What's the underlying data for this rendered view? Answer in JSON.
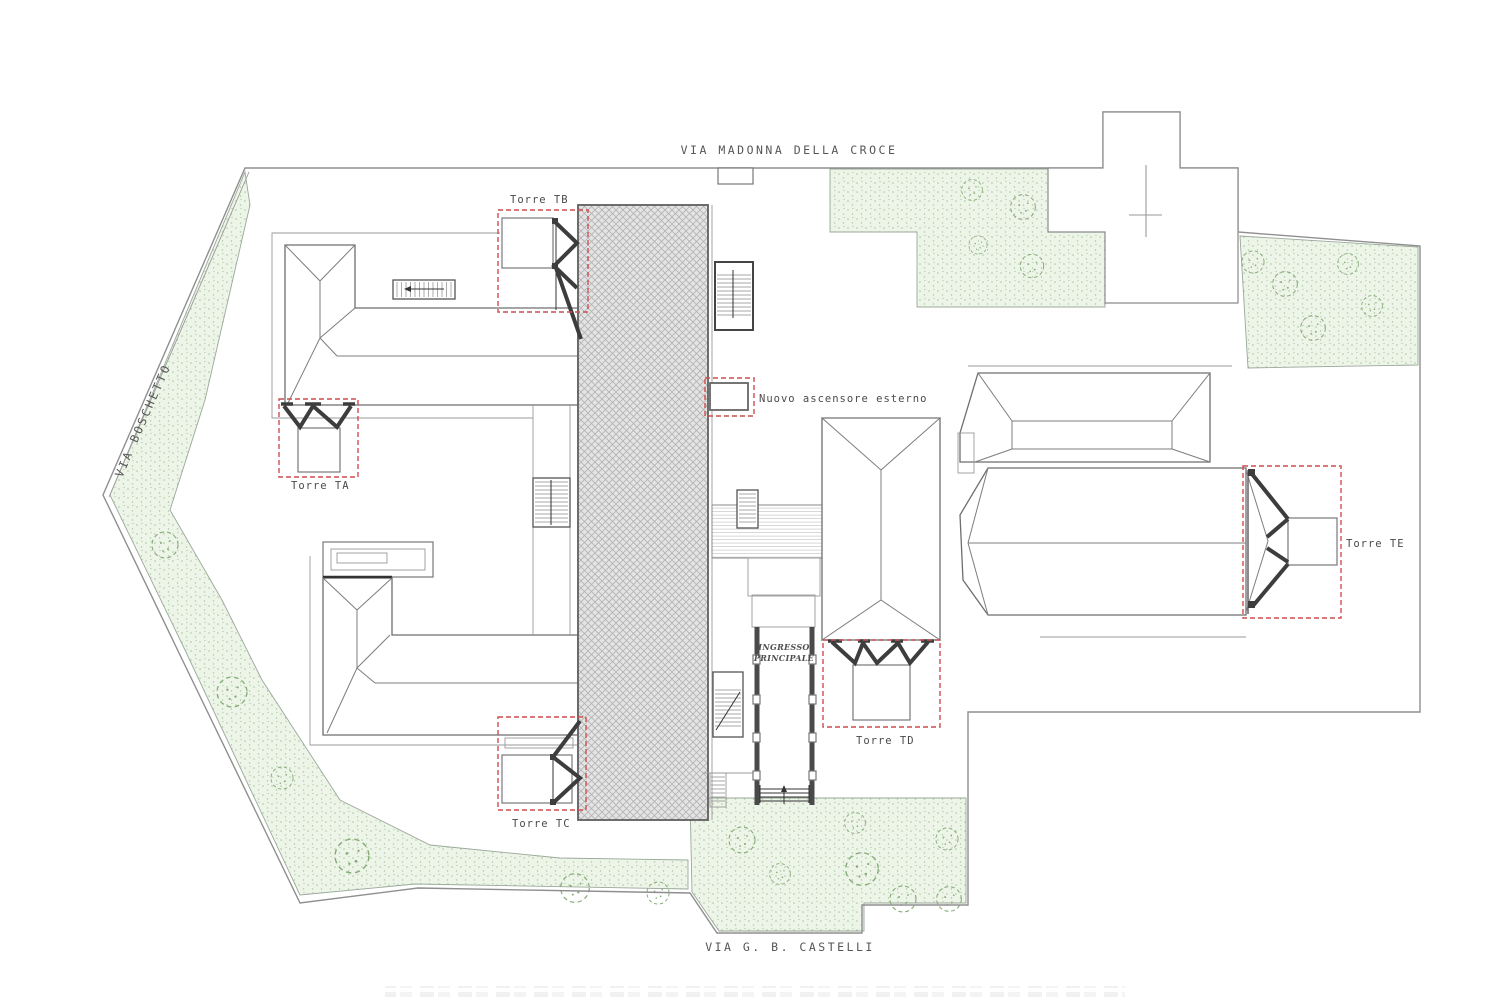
{
  "streets": {
    "top": "VIA MADONNA DELLA CROCE",
    "left": "VIA BOSCHETTO",
    "bottom": "VIA G. B. CASTELLI"
  },
  "towers": [
    {
      "id": "TA",
      "label": "Torre TA"
    },
    {
      "id": "TB",
      "label": "Torre TB"
    },
    {
      "id": "TC",
      "label": "Torre TC"
    },
    {
      "id": "TD",
      "label": "Torre TD"
    },
    {
      "id": "TE",
      "label": "Torre TE"
    }
  ],
  "annotations": {
    "elevator": "Nuovo ascensore esterno",
    "entrance_line1": "INGRESSO",
    "entrance_line2": "PRINCIPALE"
  },
  "colors": {
    "tower-red": "#cc4f4f",
    "green-fill": "#edf4e8",
    "green-dot": "#a9c89d",
    "tree-green": "#85ab77",
    "line-gray": "#8f8f8f",
    "dark-line": "#3d3d3d",
    "hatch-gray": "#c6c6c6",
    "text-gray": "#4a4a4a"
  }
}
